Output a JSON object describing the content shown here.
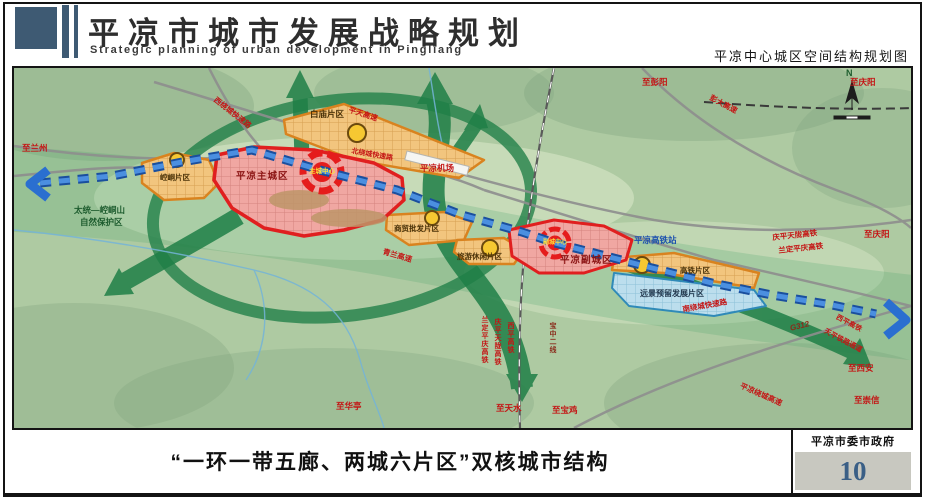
{
  "header": {
    "title": "平凉市城市发展战略规划",
    "subtitle": "Strategic planning of urban development in Pingliang",
    "map_caption": "平凉中心城区空间结构规划图"
  },
  "map": {
    "compass": "N",
    "city_areas": {
      "main_city": "平凉主城区",
      "main_center": "主城中心",
      "sub_city": "平凉副城区",
      "sub_center": "副城中心"
    },
    "districts": {
      "kongtong": "崆峒片区",
      "baimiao": "白庙片区",
      "trade": "商贸批发片区",
      "leisure": "旅游休闲片区",
      "hsr": "高铁片区",
      "reserved": "远景预留发展片区"
    },
    "roads": {
      "west_ring": "西绕城快速路",
      "north_ring": "北绕城快速路",
      "south_ring": "南绕城快速路",
      "pingtian_expwy": "平天高速",
      "pengda_expwy": "彭大高速",
      "qinglan_expwy": "青兰高速",
      "ring_expwy": "平凉绕城高速",
      "g312": "G312"
    },
    "railways": {
      "hsr_station": "平凉高铁站",
      "qingping_tianlong_hsr": "庆平天陇高铁",
      "landing_pingqing_hsr": "兰定平庆高铁",
      "xiping_hsr": "西平高铁",
      "baozhong_line2": "宝中二线",
      "tianping_corridor": "天平铁路通道"
    },
    "directions": {
      "to_lanzhou": "至兰州",
      "to_pengyang": "至彭阳",
      "to_qingyang_top": "至庆阳",
      "to_qingyang_right": "至庆阳",
      "to_huating": "至华亭",
      "to_tianshui": "至天水",
      "to_baoji": "至宝鸡",
      "to_xian": "至西安",
      "to_chongxin": "至崇信"
    },
    "features": {
      "airport": "平凉机场",
      "nature_reserve_line1": "太统—崆峒山",
      "nature_reserve_line2": "自然保护区"
    }
  },
  "footer": {
    "caption": "“一环一带五廊、两城六片区”双核城市结构",
    "organization": "平凉市委市政府",
    "page_number": "10"
  },
  "colors": {
    "header_navy": "#3e5a73",
    "ring_green": "#1f7f47",
    "corridor_blue": "#2a6fd0",
    "city_red": "#e01f1f",
    "district_orange": "#d9831f",
    "reserved_blue": "#2f8ab8",
    "page_number_blue": "#3a5f86"
  }
}
